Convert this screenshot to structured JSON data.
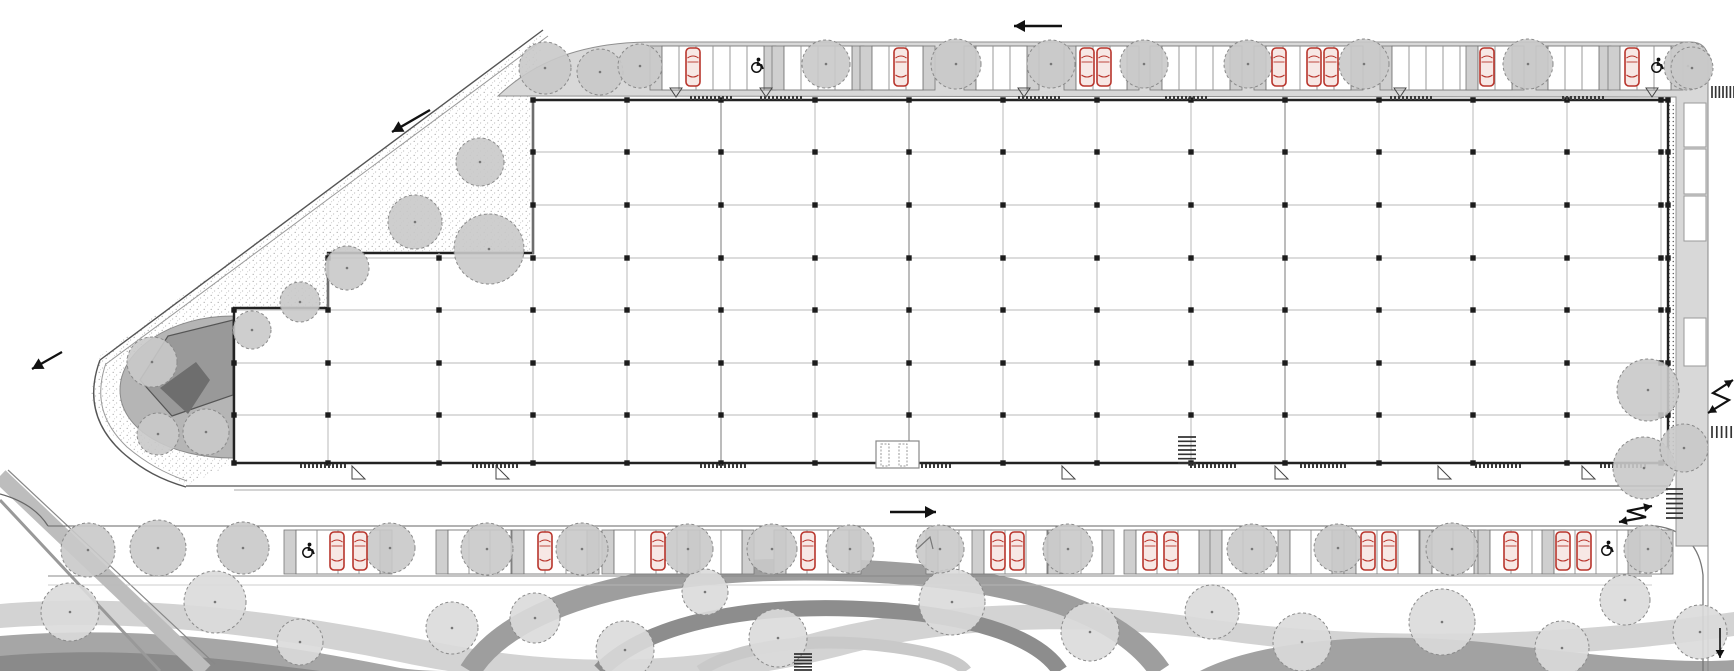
{
  "canvas": {
    "w": 1734,
    "h": 671,
    "background": "#ffffff"
  },
  "palette": {
    "band": "#d8d8d8",
    "bandEdge": "#8f8f8f",
    "wall": "#222222",
    "grid": "#b9b9b9",
    "gridDark": "#979797",
    "column": "#1c1c1c",
    "bayStroke": "#777777",
    "divider": "#cfcfcf",
    "treeFill": "#c9c9c9",
    "treeFillLight": "#dadada",
    "treeEdge": "#8a8a8a",
    "carStroke": "#b8352c",
    "carFill": "#f7e8e5",
    "walk": "#e4e4e4",
    "roadEdge": "#555555",
    "roadEdgeLight": "#999999",
    "plaza": "#b5b5b5",
    "plazaMid": "#999999",
    "plazaDark": "#6e6e6e",
    "arrow": "#111111",
    "comb": "#333333",
    "bandLight": "#d3d3d3",
    "bandMid": "#a6a6a6",
    "bandDark": "#8a8a8a"
  },
  "building": {
    "outline": "533,100 1668,100 1668,463 234,463 234,308 328,308 328,253 533,253",
    "grid_x": [
      328,
      439,
      533,
      627,
      721,
      815,
      909,
      1003,
      1097,
      1191,
      1285,
      1379,
      1473,
      1567,
      1661
    ],
    "grid_x_dark": [
      721,
      909,
      1285
    ],
    "grid_y": [
      152,
      205,
      258,
      310,
      363,
      415
    ],
    "col_x": [
      234,
      328,
      439,
      533,
      627,
      721,
      815,
      909,
      1003,
      1097,
      1191,
      1285,
      1379,
      1473,
      1567,
      1661,
      1668
    ],
    "col_y": [
      100,
      152,
      205,
      258,
      310,
      363,
      415,
      463
    ],
    "top_y": 100,
    "bottom_y": 463,
    "right_x": 1668,
    "entrance": {
      "x": 876,
      "y": 441,
      "w": 43,
      "h": 27
    },
    "thresholds_top_x": [
      690,
      760,
      1018,
      1165,
      1390,
      1562
    ],
    "thresholds_bottom_x": [
      300,
      472,
      700,
      905,
      1190,
      1300,
      1475,
      1600
    ],
    "door_tri_top_x": [
      676,
      766,
      1024,
      1400,
      1652
    ],
    "door_tri_bottom_x": [
      352,
      496,
      1062,
      1275,
      1438,
      1582
    ]
  },
  "parking": {
    "top": {
      "y": 46,
      "h": 44,
      "bay_w": 17,
      "groups": [
        [
          662,
          6
        ],
        [
          784,
          4
        ],
        [
          872,
          3
        ],
        [
          976,
          3
        ],
        [
          1076,
          3
        ],
        [
          1162,
          4
        ],
        [
          1266,
          5
        ],
        [
          1392,
          5
        ],
        [
          1478,
          2
        ],
        [
          1548,
          3
        ],
        [
          1620,
          3
        ]
      ],
      "cars_x": [
        693,
        901,
        1087,
        1104,
        1279,
        1314,
        1331,
        1487,
        1632
      ],
      "handicap": [
        [
          757,
          66
        ],
        [
          1657,
          66
        ]
      ]
    },
    "bottom": {
      "y": 530,
      "h": 44,
      "bay_w": 21,
      "groups": [
        [
          296,
          4
        ],
        [
          448,
          3
        ],
        [
          524,
          3
        ],
        [
          614,
          4
        ],
        [
          700,
          2
        ],
        [
          786,
          3
        ],
        [
          938,
          2
        ],
        [
          984,
          3
        ],
        [
          1060,
          2
        ],
        [
          1136,
          3
        ],
        [
          1222,
          3
        ],
        [
          1290,
          2
        ],
        [
          1356,
          3
        ],
        [
          1432,
          2
        ],
        [
          1490,
          3
        ],
        [
          1554,
          4
        ],
        [
          1640,
          1
        ]
      ],
      "cars_x": [
        337,
        360,
        545,
        658,
        808,
        998,
        1017,
        1150,
        1171,
        1368,
        1389,
        1511,
        1563,
        1584
      ],
      "handicap": [
        [
          308,
          551
        ],
        [
          1607,
          549
        ]
      ]
    },
    "east_bays": [
      [
        1684,
        103,
        22,
        44
      ],
      [
        1684,
        149,
        22,
        45
      ],
      [
        1684,
        196,
        22,
        45
      ],
      [
        1684,
        318,
        22,
        48
      ]
    ]
  },
  "trees": {
    "nw": [
      [
        545,
        68,
        26
      ],
      [
        600,
        72,
        23
      ],
      [
        480,
        162,
        24
      ],
      [
        415,
        222,
        27
      ],
      [
        347,
        268,
        22
      ],
      [
        489,
        249,
        35
      ],
      [
        300,
        302,
        20
      ]
    ],
    "tip": [
      [
        152,
        362,
        25
      ],
      [
        206,
        432,
        23
      ],
      [
        158,
        434,
        21
      ],
      [
        252,
        330,
        19
      ]
    ],
    "top_strip": [
      [
        640,
        66,
        22
      ],
      [
        826,
        64,
        24
      ],
      [
        956,
        64,
        25
      ],
      [
        1051,
        64,
        24
      ],
      [
        1144,
        64,
        24
      ],
      [
        1248,
        64,
        24
      ],
      [
        1364,
        64,
        25
      ],
      [
        1528,
        64,
        25
      ],
      [
        1688,
        66,
        24
      ]
    ],
    "east": [
      [
        1692,
        68,
        21
      ],
      [
        1648,
        390,
        31
      ],
      [
        1644,
        468,
        31
      ],
      [
        1684,
        448,
        24
      ]
    ],
    "bottom_strip": [
      [
        88,
        550,
        27
      ],
      [
        158,
        548,
        28
      ],
      [
        243,
        548,
        26
      ],
      [
        390,
        548,
        25
      ],
      [
        487,
        549,
        26
      ],
      [
        582,
        549,
        26
      ],
      [
        688,
        549,
        25
      ],
      [
        772,
        549,
        25
      ],
      [
        850,
        549,
        24
      ],
      [
        940,
        549,
        24
      ],
      [
        1068,
        549,
        25
      ],
      [
        1252,
        549,
        25
      ],
      [
        1338,
        548,
        24
      ],
      [
        1452,
        549,
        26
      ],
      [
        1648,
        549,
        24
      ]
    ],
    "landscape": [
      [
        70,
        612,
        29
      ],
      [
        215,
        602,
        31
      ],
      [
        300,
        642,
        23
      ],
      [
        452,
        628,
        26
      ],
      [
        535,
        618,
        25
      ],
      [
        625,
        650,
        29
      ],
      [
        705,
        592,
        23
      ],
      [
        778,
        638,
        29
      ],
      [
        952,
        602,
        33
      ],
      [
        1090,
        632,
        29
      ],
      [
        1212,
        612,
        27
      ],
      [
        1302,
        642,
        29
      ],
      [
        1442,
        622,
        33
      ],
      [
        1562,
        648,
        27
      ],
      [
        1625,
        600,
        25
      ],
      [
        1700,
        632,
        27
      ]
    ]
  },
  "arrows": {
    "straight": [
      {
        "name": "traffic-arrow-west-top",
        "x1": 1062,
        "y1": 26,
        "x2": 1014,
        "y2": 26,
        "w": 2.6
      },
      {
        "name": "traffic-arrow-sw-diagonal",
        "x1": 430,
        "y1": 110,
        "x2": 392,
        "y2": 132,
        "w": 2.4
      },
      {
        "name": "traffic-arrow-sw-left",
        "x1": 62,
        "y1": 352,
        "x2": 32,
        "y2": 369,
        "w": 2.2
      },
      {
        "name": "traffic-arrow-east-road",
        "x1": 890,
        "y1": 512,
        "x2": 936,
        "y2": 512,
        "w": 2.6
      },
      {
        "name": "traffic-arrow-south-right",
        "x1": 1720,
        "y1": 628,
        "x2": 1720,
        "y2": 658,
        "w": 1.6
      }
    ],
    "zigzag": [
      {
        "name": "ramp-arrow-east",
        "pts": [
          [
            1733,
            380
          ],
          [
            1713,
            393
          ],
          [
            1729,
            400
          ],
          [
            1708,
            413
          ]
        ]
      },
      {
        "name": "ramp-arrow-southeast",
        "pts": [
          [
            1652,
            506
          ],
          [
            1627,
            511
          ],
          [
            1646,
            517
          ],
          [
            1619,
            522
          ]
        ]
      }
    ]
  },
  "combs": [
    {
      "name": "crosswalk-northeast",
      "x": 1712,
      "y": 86,
      "w": 22,
      "h": 12,
      "n": 7,
      "dir": "v"
    },
    {
      "name": "crosswalk-east",
      "x": 1712,
      "y": 426,
      "w": 24,
      "h": 12,
      "n": 6,
      "dir": "v"
    },
    {
      "name": "crosswalk-southeast",
      "x": 1666,
      "y": 489,
      "w": 17,
      "h": 29,
      "n": 7,
      "dir": "h"
    },
    {
      "name": "crosswalk-path",
      "x": 794,
      "y": 654,
      "w": 18,
      "h": 16,
      "n": 6,
      "dir": "h"
    },
    {
      "name": "stair-south",
      "x": 1178,
      "y": 437,
      "w": 18,
      "h": 26,
      "n": 7,
      "dir": "h"
    }
  ],
  "shapes_bg": [
    {
      "t": "rect",
      "n": "landscape-ground",
      "x": 0,
      "y": 583,
      "w": 1734,
      "h": 88,
      "f": "url(#stip)"
    },
    {
      "t": "path",
      "n": "landscape-band-light",
      "d": "M0,604 C140,592 300,614 430,641 C560,668 690,666 810,634 C930,602 1060,596 1200,618 C1340,638 1520,642 1734,612 L1734,636 C1540,664 1360,660 1220,640 C1080,622 950,626 840,656 C700,692 540,692 400,662 C260,634 130,618 0,628 Z",
      "f": "#d3d3d3"
    },
    {
      "t": "path",
      "n": "landscape-swirl-outer",
      "d": "M470,671 C520,590 700,560 880,572 C1020,580 1120,612 1160,671",
      "f": "none",
      "s": "#9e9e9e",
      "sw": 22
    },
    {
      "t": "path",
      "n": "landscape-swirl-inner",
      "d": "M600,671 C650,620 760,602 880,610 C980,616 1040,640 1060,671",
      "f": "none",
      "s": "#8d8d8d",
      "sw": 16
    },
    {
      "t": "path",
      "n": "landscape-swirl-core",
      "d": "M700,671 C740,644 820,636 900,648 C940,654 960,662 966,671",
      "f": "none",
      "s": "#c9c9c9",
      "sw": 12
    },
    {
      "t": "path",
      "n": "landscape-band-mid",
      "d": "M0,636 C150,624 280,644 400,668 C420,671 440,671 460,671 L0,671 Z",
      "f": "#a6a6a6"
    },
    {
      "t": "path",
      "n": "landscape-band-dark",
      "d": "M0,656 C120,646 220,658 320,671 L0,671 Z",
      "f": "#8a8a8a"
    },
    {
      "t": "path",
      "n": "landscape-band-mid-right",
      "d": "M1200,671 C1260,640 1380,630 1500,644 C1600,656 1680,664 1734,660 L1734,671 Z",
      "f": "#a2a2a2"
    },
    {
      "t": "line",
      "n": "road-southwest-wide",
      "x1": 0,
      "y1": 476,
      "x2": 205,
      "y2": 671,
      "s": "#bdbdbd",
      "sw": 16
    },
    {
      "t": "line",
      "n": "road-southwest-mid",
      "x1": 0,
      "y1": 500,
      "x2": 160,
      "y2": 671,
      "s": "#999999",
      "sw": 3
    },
    {
      "t": "line",
      "n": "road-southwest-thin",
      "x1": 8,
      "y1": 470,
      "x2": 215,
      "y2": 664,
      "s": "#888888",
      "sw": 1.2
    },
    {
      "t": "rect",
      "n": "garden-path",
      "x": 797,
      "y": 576,
      "w": 14,
      "h": 95,
      "f": "#ededed",
      "s": "#a8a8a8",
      "sw": 0.8
    },
    {
      "t": "polygon",
      "n": "nw-grove-ground",
      "p": "543,33 533,100 533,253 328,253 328,308 234,308 234,463 186,486 110,433 90,396 100,356",
      "f": "url(#stip)"
    },
    {
      "t": "path",
      "n": "tip-plaza",
      "d": "M233,316 C170,316 120,350 120,390 C120,430 170,458 233,458 Z",
      "f": "#b5b5b5",
      "s": "#8a8a8a",
      "sw": 1
    },
    {
      "t": "polygon",
      "n": "tip-pavilion",
      "p": "233,320 233,395 172,416 140,380 168,336",
      "f": "#999999",
      "s": "#555555",
      "sw": 1.2
    },
    {
      "t": "polygon",
      "n": "tip-pavilion-core",
      "p": "210,380 188,414 160,388 196,362",
      "f": "#6e6e6e"
    },
    {
      "t": "line",
      "n": "site-boundary-outer",
      "x1": 543,
      "y1": 30,
      "x2": 100,
      "y2": 360,
      "s": "#555555",
      "sw": 1.4
    },
    {
      "t": "line",
      "n": "site-boundary-inner",
      "x1": 548,
      "y1": 36,
      "x2": 106,
      "y2": 364,
      "s": "#999999",
      "sw": 1
    },
    {
      "t": "path",
      "n": "tip-road-outer",
      "d": "M100,360 C86,398 96,428 122,452 C142,470 162,480 186,487",
      "f": "none",
      "s": "#555555",
      "sw": 1.4
    },
    {
      "t": "path",
      "n": "tip-road-inner",
      "d": "M106,363 C94,398 103,424 127,447 C146,463 164,473 187,481",
      "f": "none",
      "s": "#999999",
      "sw": 1
    },
    {
      "t": "rect",
      "n": "south-walkway",
      "x": 234,
      "y": 463,
      "w": 1434,
      "h": 21,
      "f": "#e4e4e4"
    },
    {
      "t": "line",
      "n": "south-road-edge-top",
      "x1": 186,
      "y1": 486,
      "x2": 1668,
      "y2": 486,
      "s": "#555555",
      "sw": 1.3
    },
    {
      "t": "line",
      "n": "south-road-edge-top2",
      "x1": 234,
      "y1": 490,
      "x2": 1668,
      "y2": 490,
      "s": "#aaaaaa",
      "sw": 1
    },
    {
      "t": "path",
      "n": "southwest-road-curve",
      "d": "M0,494 C22,500 38,510 48,526",
      "f": "none",
      "s": "#666666",
      "sw": 1.2
    },
    {
      "t": "rect",
      "n": "south-parking-band",
      "x": 48,
      "y": 526,
      "w": 1608,
      "h": 50,
      "f": "#d8d8d8"
    },
    {
      "t": "line",
      "n": "south-band-top-edge",
      "x1": 48,
      "y1": 526,
      "x2": 1656,
      "y2": 526,
      "s": "#666666",
      "sw": 1
    },
    {
      "t": "line",
      "n": "south-band-walk-edge",
      "x1": 48,
      "y1": 576,
      "x2": 1652,
      "y2": 576,
      "s": "#888888",
      "sw": 1
    },
    {
      "t": "line",
      "n": "south-band-walk-edge2",
      "x1": 48,
      "y1": 585,
      "x2": 1652,
      "y2": 585,
      "s": "#bbbbbb",
      "sw": 0.8
    },
    {
      "t": "path",
      "n": "southeast-corner-road",
      "d": "M1656,526 C1686,530 1700,548 1703,575 L1703,671",
      "f": "none",
      "s": "#777777",
      "sw": 1.3
    },
    {
      "t": "path",
      "n": "north-parking-band",
      "d": "M498,96 C540,56 592,42 652,42 L1690,42 C1702,42 1708,48 1708,60 L1708,546 L1676,546 L1676,97 Z",
      "f": "#d8d8d8",
      "s": "#8f8f8f",
      "sw": 1
    },
    {
      "t": "line",
      "n": "east-band-inner-edge",
      "x1": 1676,
      "y1": 100,
      "x2": 1676,
      "y2": 546,
      "s": "#999999",
      "sw": 0.8
    },
    {
      "t": "line",
      "n": "east-road-edge",
      "x1": 1708,
      "y1": 60,
      "x2": 1708,
      "y2": 671,
      "s": "#888888",
      "sw": 1
    }
  ],
  "shapes_fg": [
    {
      "t": "rect",
      "n": "east-kiosk",
      "x": 1686,
      "y": 409,
      "w": 21,
      "h": 21,
      "f": "#eeeeee",
      "s": "#777777",
      "sw": 1.2
    },
    {
      "t": "rect",
      "n": "east-kiosk-core",
      "x": 1691,
      "y": 414,
      "w": 11,
      "h": 11,
      "f": "none",
      "s": "#777777",
      "sw": 1
    },
    {
      "t": "rect",
      "n": "south-strip-structure",
      "x": 891,
      "y": 542,
      "w": 44,
      "h": 32,
      "f": "#ffffff",
      "s": "#333333",
      "sw": 1.5
    },
    {
      "t": "polyline",
      "n": "south-strip-structure-mark",
      "p": "917,549 930,537 933,549",
      "f": "none",
      "s": "#777777",
      "sw": 1.2
    }
  ]
}
